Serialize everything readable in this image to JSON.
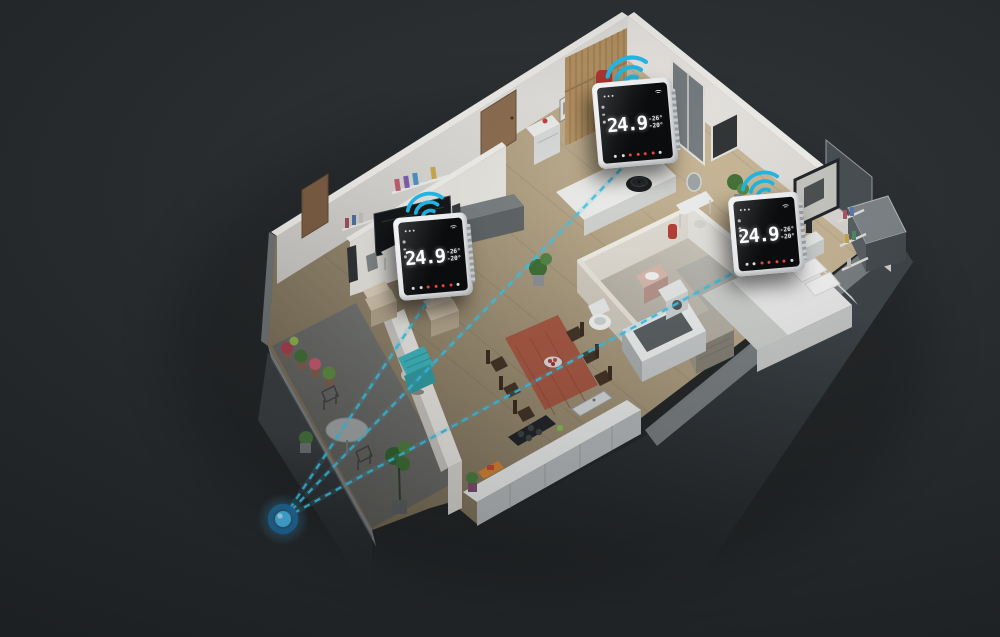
{
  "colors": {
    "background": "#282c2f",
    "accent": "#27b9e3",
    "dash_line": "#3ac2e6",
    "hub_core": "#47bcf1",
    "hub_ring": "#1d6ea3",
    "wifi_icon": "#22b4e0",
    "thermostat_frame": "#f4f5f6",
    "thermostat_screen": "#0a0c0e",
    "display_text": "#ffffff",
    "touch_dot_red": "#e2473c",
    "touch_dot_white": "#d9dbdc"
  },
  "scene": {
    "type": "smart-home-3d-cutaway-apartment",
    "rooms": [
      "living-room",
      "hallway",
      "entry-bedroom",
      "bedroom",
      "bathroom",
      "kitchen-dining",
      "balcony"
    ]
  },
  "devices": [
    {
      "id": "thermostat-1",
      "display": {
        "temp_main": "24.9",
        "sub_top": "-26°",
        "sub_bottom": "-20°"
      },
      "touch_dots": [
        "#d9dbdc",
        "#d9dbdc",
        "#e2473c",
        "#e2473c",
        "#e2473c",
        "#e2473c",
        "#d9dbdc"
      ]
    },
    {
      "id": "thermostat-2",
      "display": {
        "temp_main": "24.9",
        "sub_top": "-26°",
        "sub_bottom": "-20°"
      },
      "touch_dots": [
        "#d9dbdc",
        "#d9dbdc",
        "#e2473c",
        "#e2473c",
        "#e2473c",
        "#e2473c",
        "#d9dbdc"
      ]
    },
    {
      "id": "thermostat-3",
      "display": {
        "temp_main": "24.9",
        "sub_top": "-26°",
        "sub_bottom": "-20°"
      },
      "touch_dots": [
        "#d9dbdc",
        "#d9dbdc",
        "#e2473c",
        "#e2473c",
        "#e2473c",
        "#e2473c",
        "#d9dbdc"
      ]
    }
  ],
  "network": {
    "hub_icon": "hub-glow-dot",
    "links": [
      {
        "from": "hub",
        "to": "thermostat-1",
        "style": "dashed"
      },
      {
        "from": "hub",
        "to": "thermostat-2",
        "style": "dashed"
      },
      {
        "from": "hub",
        "to": "thermostat-3",
        "style": "dashed"
      }
    ]
  },
  "icons": {
    "wifi": "wifi-signal-icon",
    "hub": "gateway-hub-dot"
  }
}
